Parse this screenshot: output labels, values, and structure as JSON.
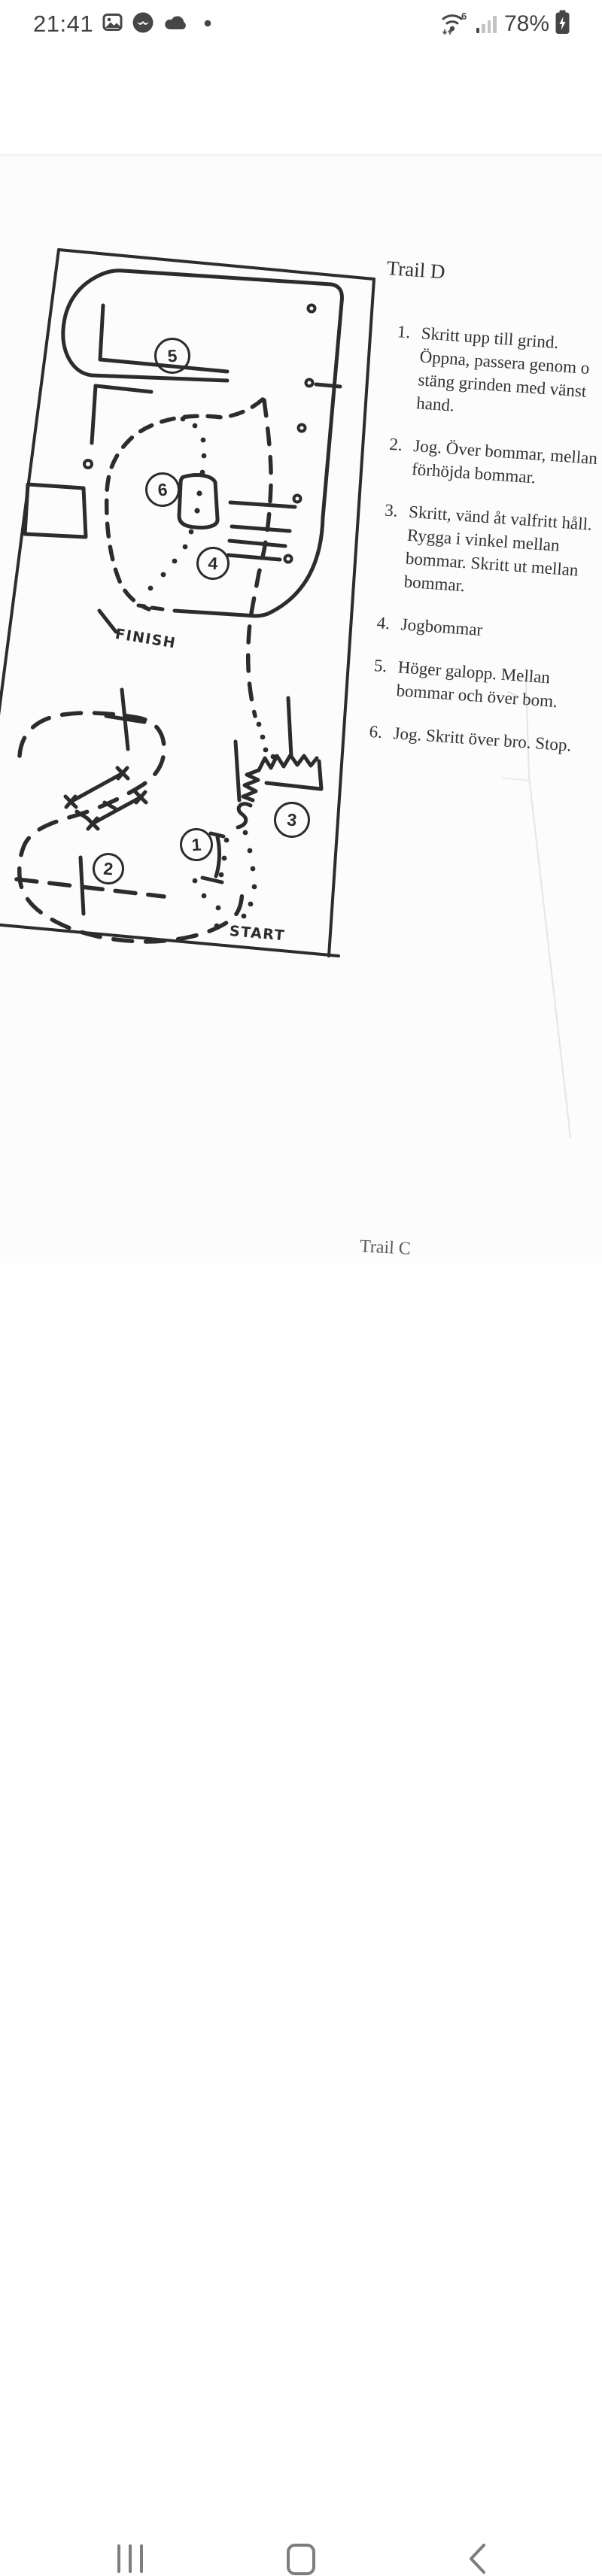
{
  "status_bar": {
    "time": "21:41",
    "wifi_standard": "6",
    "battery_percent": "78%"
  },
  "course_map": {
    "title": "Trail D",
    "finish_label": "FINISH",
    "start_label": "START",
    "markers": [
      {
        "label": "1"
      },
      {
        "label": "2"
      },
      {
        "label": "3"
      },
      {
        "label": "4"
      },
      {
        "label": "5"
      },
      {
        "label": "6"
      }
    ]
  },
  "instructions": {
    "items": [
      {
        "num": "1.",
        "lines": [
          "Skritt upp till grind.",
          "Öppna, passera genom o",
          "stäng grinden med vänst",
          "hand."
        ]
      },
      {
        "num": "2.",
        "lines": [
          "Jog. Över bommar, mellan",
          "förhöjda bommar."
        ]
      },
      {
        "num": "3.",
        "lines": [
          "Skritt, vänd åt valfritt håll.",
          "Rygga i vinkel mellan",
          "bommar. Skritt ut mellan",
          "bommar."
        ]
      },
      {
        "num": "4.",
        "lines": [
          "Jogbommar"
        ]
      },
      {
        "num": "5.",
        "lines": [
          "Höger galopp. Mellan",
          "bommar och över bom."
        ]
      },
      {
        "num": "6.",
        "lines": [
          "Jog. Skritt över bro. Stop."
        ]
      }
    ]
  },
  "next_page_title": "Trail C",
  "colors": {
    "ink": "#2c2c2c",
    "status_icon": "#464646",
    "nav_icon": "#7d7d7d"
  }
}
